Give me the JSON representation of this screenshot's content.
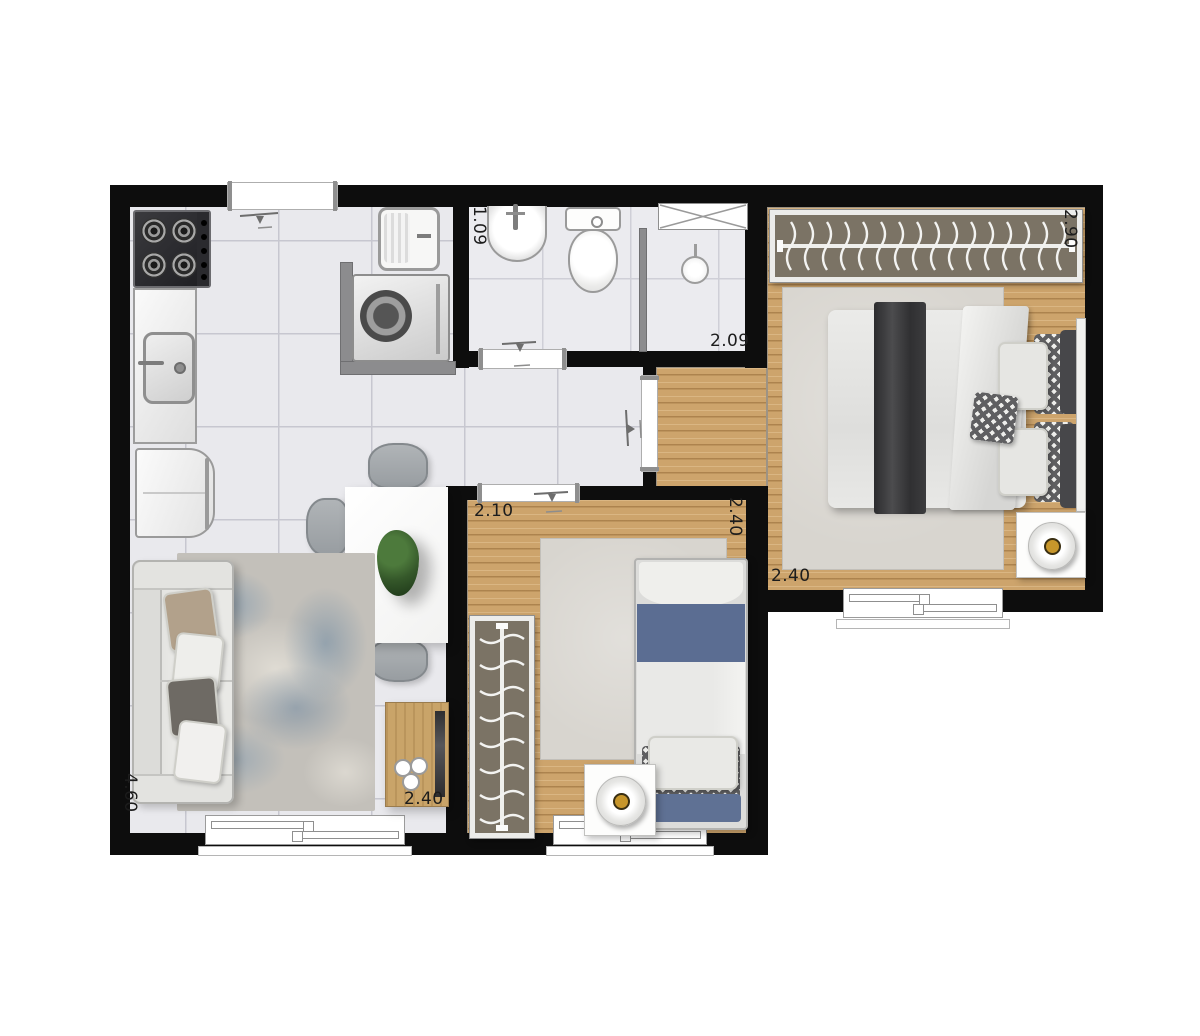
{
  "dimension_labels": [
    {
      "id": "bathroom-width",
      "text": "1.09",
      "orientation": "vertical"
    },
    {
      "id": "bathroom-length",
      "text": "2.09",
      "orientation": "horizontal"
    },
    {
      "id": "bedroom1-length",
      "text": "2.90",
      "orientation": "vertical"
    },
    {
      "id": "bedroom1-width",
      "text": "2.40",
      "orientation": "horizontal"
    },
    {
      "id": "bedroom2-width",
      "text": "2.10",
      "orientation": "horizontal"
    },
    {
      "id": "bedroom2-length",
      "text": "2.40",
      "orientation": "vertical"
    },
    {
      "id": "living-length",
      "text": "4.60",
      "orientation": "vertical"
    },
    {
      "id": "living-width",
      "text": "2.40",
      "orientation": "horizontal"
    }
  ],
  "colors": {
    "wall": "#0d0d0d",
    "tile_floor": "#e9e9ed",
    "wood_floor": "#cda46c",
    "closet_interior": "#7b7365",
    "rug_blue": "#8099ad",
    "bed_blue": "#5b6d92",
    "lamp_accent": "#c7962b"
  }
}
